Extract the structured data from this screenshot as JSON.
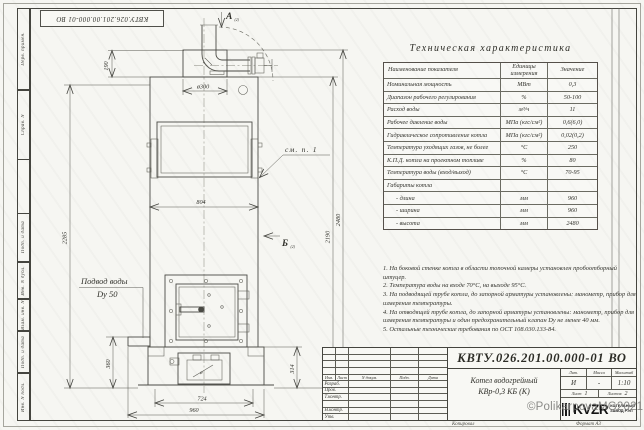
{
  "frame": {
    "stamp_top": "КВТУ.026.201.00.000-01 ВО",
    "margin_labels": [
      "Перв. примен.",
      "Справ. N",
      "Подп. и дата",
      "Инв. N дубл.",
      "Взам. инв. N",
      "Подп. и дата",
      "Инв. N подл."
    ],
    "format_label": "Формат А3",
    "copied_label": "Копировал"
  },
  "drawing": {
    "view_a": "А",
    "view_b": "Б",
    "view_ref": "(2)",
    "callout_see_note": "см. п. 1",
    "water_inlet_line1": "Подвод воды",
    "water_inlet_line2": "Dy 50",
    "phi_mark": "ø",
    "dims": {
      "d300": "ø300",
      "h190": "190",
      "w804": "804",
      "h2285": "2285",
      "h2190": "2190",
      "h2480": "2480",
      "h360": "360",
      "h314": "314",
      "w724": "724",
      "w960": "960"
    }
  },
  "spec_table": {
    "title": "Техническая характеристика",
    "headers": [
      "Наименование показателя",
      "Единицы измерения",
      "Значение"
    ],
    "rows": [
      [
        "Номинальная мощность",
        "МВт",
        "0,3"
      ],
      [
        "Диапазон рабочего регулирования",
        "%",
        "50-100"
      ],
      [
        "Расход воды",
        "м³/ч",
        "11"
      ],
      [
        "Рабочее давление воды",
        "МПа (кгс/см²)",
        "0,6(6,0)"
      ],
      [
        "Гидравлическое сопротивление котла",
        "МПа (кгс/см²)",
        "0,02(0,2)"
      ],
      [
        "Температура уходящих газов, не более",
        "°С",
        "250"
      ],
      [
        "К.П.Д. котла на проектном топливе",
        "%",
        "80"
      ],
      [
        "Температура воды (вход/выход)",
        "°С",
        "70-95"
      ],
      [
        "Габариты котла",
        "",
        ""
      ],
      [
        "- длина",
        "мм",
        "960"
      ],
      [
        "- ширина",
        "мм",
        "960"
      ],
      [
        "- высота",
        "мм",
        "2480"
      ]
    ]
  },
  "notes": [
    "1. На боковой стенке котла в области топочной камеры установлен пробоотборный штуцер.",
    "2. Температура воды на входе 70°С, на выходе 95°С.",
    "3. На подводящей трубе котла, до запорной арматуры установлены: манометр, прибор для измерения температуры.",
    "4. На отводящей трубе котла, до запорной арматуры установлены: манометр, прибор для измерения температуры и один предохранительный клапан Dy не менее 40 мм.",
    "5. Остальные технические требования по ОСТ 108.030.133-84."
  ],
  "title_block": {
    "doc_number": "КВТУ.026.201.00.000-01 ВО",
    "product_line1": "Котел водогрейный",
    "product_line2": "КВр-0,3  КБ  (К)",
    "col_headers": {
      "izm": "Изм.",
      "list": "Лист",
      "ndoc": "N докум.",
      "podp": "Подп.",
      "data": "Дата"
    },
    "row_labels": {
      "razrab": "Разраб.",
      "prov": "Пров.",
      "tkontr": "Т.контр.",
      "nkontr": "Н.контр.",
      "utv": "Утв."
    },
    "lit_header": "Лит.",
    "mass_header": "Масса",
    "scale_header": "Масштаб",
    "lit_value": "И",
    "mass_value": "-",
    "scale_value": "1:10",
    "sheet_label": "Лист",
    "sheet_value": "1",
    "sheets_label": "Листов",
    "sheets_value": "2",
    "logo_text": "KVZR",
    "logo_caption_line1": "КОТЕЛЬНЫЙ",
    "logo_caption_line2": "ЗАВОД РЭП",
    "watermark": "©PolikarpovaMG2021"
  }
}
